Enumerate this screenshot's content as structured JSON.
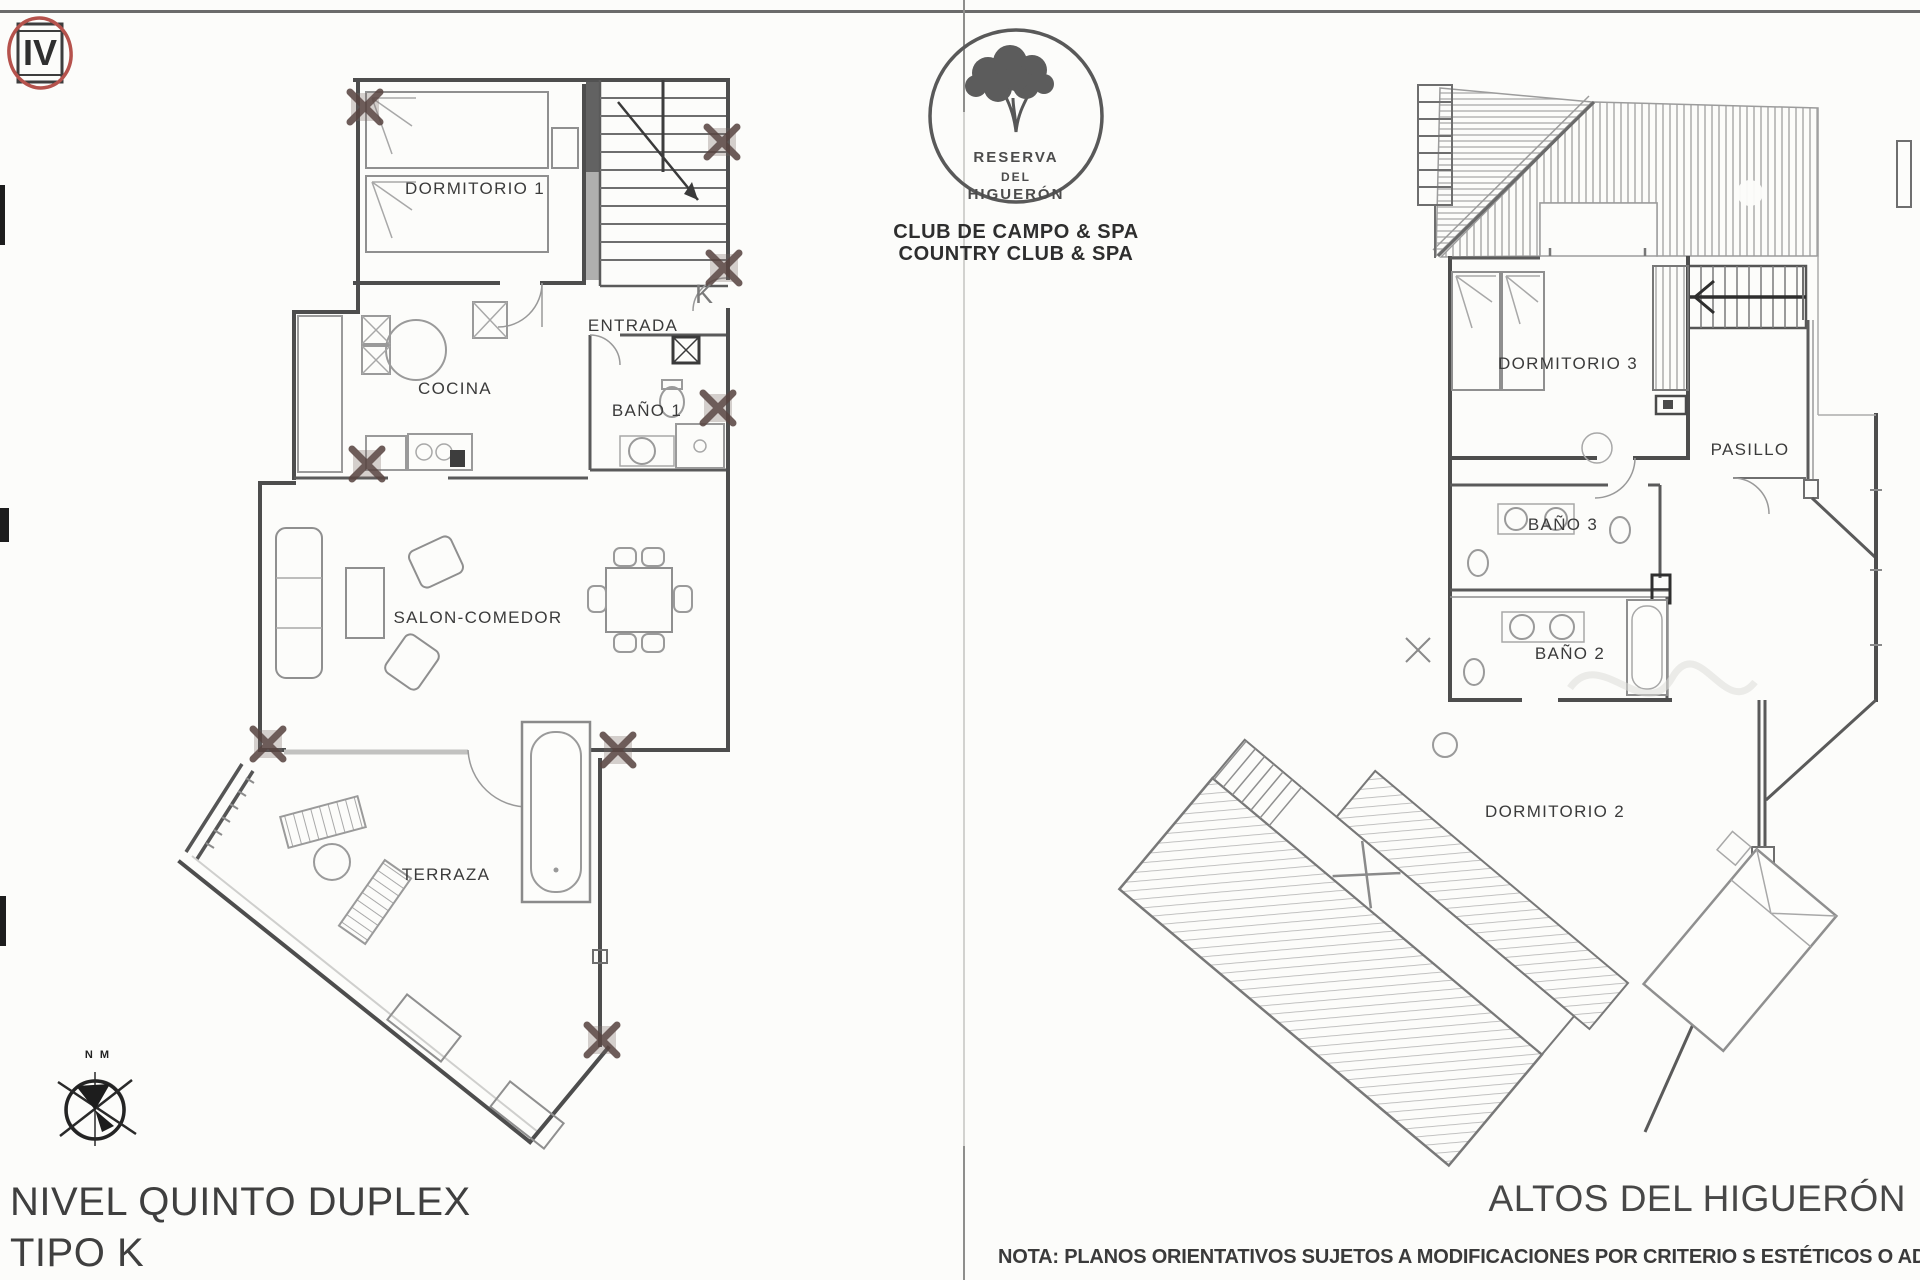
{
  "emblem": {
    "numeral": "IV"
  },
  "logo": {
    "name_line1": "RESERVA",
    "name_line2": "DEL",
    "name_line3": "HIGUERÓN",
    "club_line1": "CLUB DE CAMPO & SPA",
    "club_line2": "COUNTRY CLUB & SPA"
  },
  "left_plan": {
    "rooms": {
      "dormitorio1": "DORMITORIO 1",
      "entrada": "ENTRADA",
      "cocina": "COCINA",
      "bano1": "BAÑO 1",
      "salon": "SALON-COMEDOR",
      "terraza": "TERRAZA"
    },
    "door_label": "K",
    "compass_label": "N M",
    "title_line1": "NIVEL QUINTO DUPLEX",
    "title_line2": "TIPO K"
  },
  "right_plan": {
    "rooms": {
      "dormitorio3": "DORMITORIO 3",
      "pasillo": "PASILLO",
      "bano3": "BAÑO 3",
      "bano2": "BAÑO 2",
      "dormitorio2": "DORMITORIO 2"
    },
    "title": "ALTOS DEL HIGUERÓN"
  },
  "footer": {
    "note": "NOTA: PLANOS ORIENTATIVOS SUJETOS A MODIFICACIONES POR CRITERIO S ESTÉTICOS O ADMINISTRATIV"
  },
  "colors": {
    "accent_red": "#b5524c",
    "wall_gray": "#4d4d4d",
    "hatch_gray": "#b3b3b3",
    "text_dark": "#343434"
  }
}
